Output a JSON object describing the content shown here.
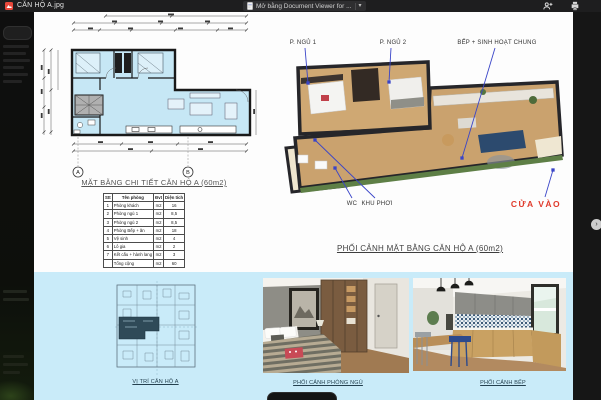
{
  "topbar": {
    "filename": "CĂN HỘ A.jpg",
    "open_with_label": "Mở bằng Document Viewer for ...",
    "caret": "▾"
  },
  "document": {
    "plan_title": "MẶT BẰNG CHI TIẾT CĂN HỘ A (60m2)",
    "perspective_title": "PHỐI CẢNH MẶT BẰNG CĂN HỘ A (60m2)",
    "room_labels": {
      "bedroom1": "P. NGỦ 1",
      "bedroom2": "P. NGỦ 2",
      "kitchen_living": "BẾP + SINH HOẠT CHUNG",
      "wc": "WC",
      "laundry": "KHU PHƠI",
      "entrance": "CỬA VÀO"
    },
    "axis_markers": [
      "A",
      "B"
    ],
    "area_table": {
      "headers": [
        "Stt",
        "Tên phòng",
        "Đvt",
        "Diện tích"
      ],
      "rows": [
        [
          "1",
          "Phòng khách",
          "m2",
          "16"
        ],
        [
          "2",
          "Phòng ngủ 1",
          "m2",
          "8,5"
        ],
        [
          "3",
          "Phòng ngủ 2",
          "m2",
          "8,5"
        ],
        [
          "4",
          "Phòng Bếp + ăn",
          "m2",
          "18"
        ],
        [
          "5",
          "Vệ sinh",
          "m2",
          "4"
        ],
        [
          "6",
          "Lô gia",
          "m2",
          "2"
        ],
        [
          "7",
          "Kết cấu + hành lang",
          "m2",
          "3"
        ],
        [
          "",
          "Tổng cộng",
          "m2",
          "60"
        ]
      ]
    },
    "bottom_captions": [
      "VỊ TRÍ CĂN HỘ A",
      "PHỐI CẢNH PHÒNG NGỦ",
      "PHỐI CẢNH BẾP"
    ]
  },
  "colors": {
    "entrance_red": "#e03a2b",
    "leader_blue": "#3a45c8",
    "band_blue": "#c9ebf9",
    "plan_fill": "#c6e7f5"
  }
}
